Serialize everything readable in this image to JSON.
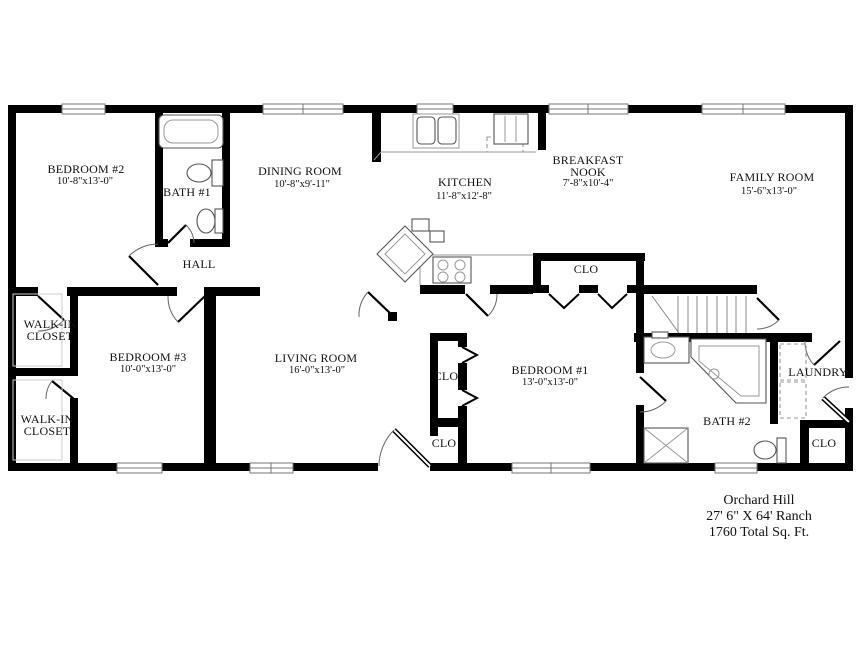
{
  "labels": {
    "bedroom2_name": "BEDROOM #2",
    "bedroom2_dims": "10'-8\"x13'-0\"",
    "bath1": "BATH #1",
    "dining_name": "DINING ROOM",
    "dining_dims": "10'-8\"x9'-11\"",
    "kitchen_name": "KITCHEN",
    "kitchen_dims": "11'-8\"x12'-8\"",
    "nook_line1": "BREAKFAST",
    "nook_line2": "NOOK",
    "nook_dims": "7'-8\"x10'-4\"",
    "family_name": "FAMILY ROOM",
    "family_dims": "15'-6\"x13'-0\"",
    "hall": "HALL",
    "walkin_line1": "WALK-IN",
    "walkin_line2": "CLOSET",
    "bedroom3_name": "BEDROOM #3",
    "bedroom3_dims": "10'-0\"x13'-0\"",
    "living_name": "LIVING ROOM",
    "living_dims": "16'-0\"x13'-0\"",
    "bedroom1_name": "BEDROOM #1",
    "bedroom1_dims": "13'-0\"x13'-0\"",
    "clo": "CLO",
    "laundry": "LAUNDRY",
    "bath2": "BATH #2"
  },
  "title_block": {
    "line1": "Orchard Hill",
    "line2": "27' 6\" X 64' Ranch",
    "line3": "1760 Total Sq. Ft."
  },
  "colors": {
    "wall": "#000000",
    "background": "#ffffff",
    "fixture": "#555555",
    "fixture_light": "#999999",
    "window_line": "#777777",
    "text": "#111111"
  }
}
